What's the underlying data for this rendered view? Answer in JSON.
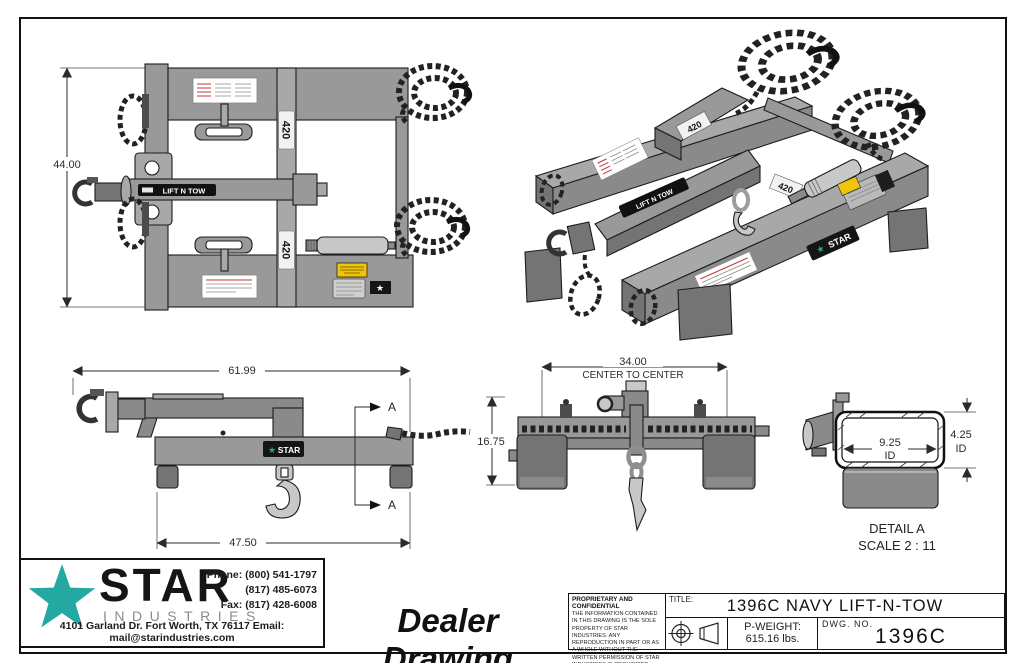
{
  "sheet": {
    "plan_view": {
      "height_dim": "44.00",
      "boom_label": "LIFT N TOW",
      "pocket_label_top": "420",
      "pocket_label_bottom": "420",
      "star_glyph": "★"
    },
    "iso_view": {
      "rear_pocket_label": "420",
      "right_pocket_label": "420",
      "boom_label": "LIFT N TOW",
      "brand_badge": "STAR",
      "star_glyph": "★"
    },
    "side_view": {
      "overall_length_dim": "61.99",
      "base_length_dim": "47.50",
      "section_marker": "A",
      "brand_badge": "STAR",
      "star_glyph": "★"
    },
    "front_view": {
      "width_dim": "34.00",
      "width_dim_note": "CENTER TO CENTER",
      "height_dim": "16.75"
    },
    "detail_view": {
      "inner_width_dim": "9.25",
      "inner_width_suffix": "ID",
      "inner_height_dim": "4.25",
      "inner_height_suffix": "ID",
      "caption": "DETAIL A",
      "scale_note": "SCALE 2 : 11"
    }
  },
  "footer": {
    "logo": {
      "brand": "STAR",
      "brand_sub": "INDUSTRIES",
      "phone_line1": "Phone: (800) 541-1797",
      "phone_line2": "(817) 485-6073",
      "fax_line": "Fax: (817) 428-6008",
      "address_line": "4101 Garland Dr. Fort Worth, TX 76117  Email: mail@starindustries.com"
    },
    "drawing_type": "Dealer Drawing",
    "title_block": {
      "proprietary_heading": "PROPRIETARY AND CONFIDENTIAL",
      "proprietary_body": "THE INFORMATION CONTAINED IN THIS DRAWING IS THE SOLE PROPERTY OF STAR INDUSTRIES.  ANY REPRODUCTION IN PART OR AS A WHOLE WITHOUT THE WRITTEN PERMISSION OF STAR INDUSTRIES IS PROHIBITED.",
      "title_label": "TITLE:",
      "title": "1396C NAVY LIFT-N-TOW",
      "pweight_label": "P-WEIGHT:",
      "pweight_value": "615.16 lbs.",
      "dwg_label": "DWG.  NO.",
      "dwg_number": "1396C"
    }
  },
  "colors": {
    "brand_teal": "#23a8a2",
    "part_gray": "#9b9b9b",
    "part_gray_dark": "#757575",
    "caution_yellow": "#f0c40a",
    "warning_red": "#c23a3a",
    "line_black": "#1c1c1c"
  }
}
